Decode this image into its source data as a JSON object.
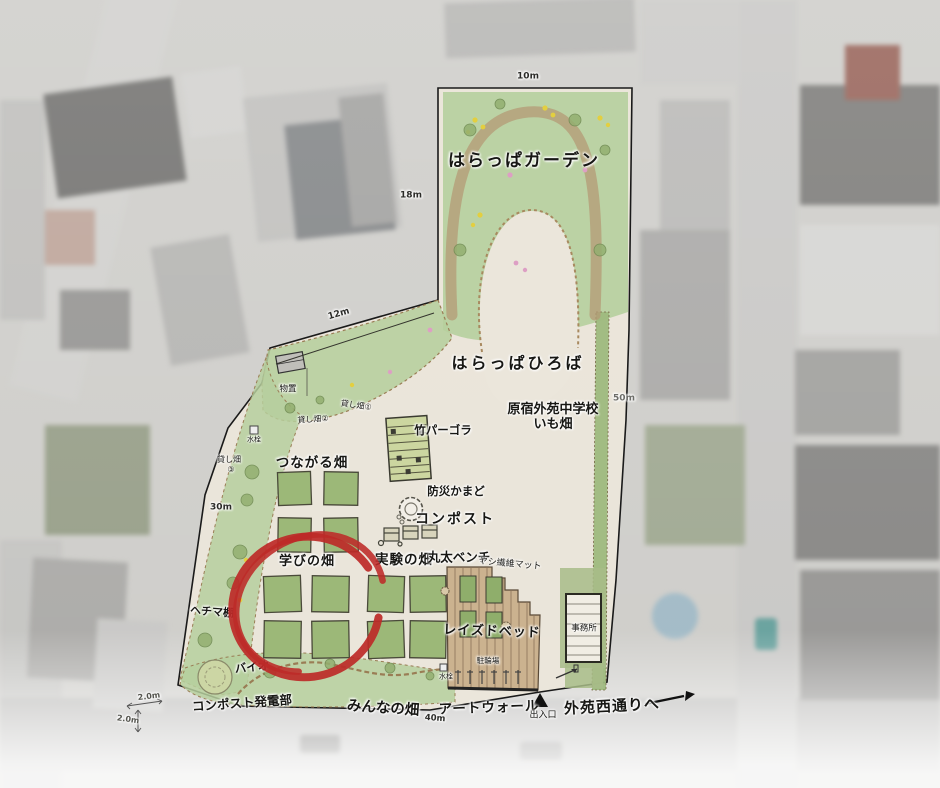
{
  "labels": {
    "harappa_garden": "はらっぱガーデン",
    "harappa_hiroba": "はらっぱひろば",
    "school_field_line1": "原宿外苑中学校",
    "school_field_line2": "いも畑",
    "bamboo_pergola": "竹パーゴラ",
    "disaster_stove": "防災かまど",
    "compost": "コンポスト",
    "tsunagaru_field": "つながる畑",
    "manabi_field": "学びの畑",
    "jikken_field": "実験の畑",
    "log_bench": "丸太ベンチ",
    "palm_fiber_mat": "ヤシ繊維マット",
    "raised_bed": "レイズドベッド",
    "office": "事務所",
    "bicycle_parking": "駐輪場",
    "water_tap_upper": "水栓",
    "water_tap_lower": "水栓",
    "hechima_trellis": "ヘチマ棚",
    "bio_nest": "バイオ",
    "compost_power": "コンポスト発電部",
    "minna_field": "みんなの畑",
    "art_wall": "アートウォール",
    "entrance": "出入口",
    "gaien_street": "外苑西通りへ",
    "storage": "物置",
    "rental_field_1": "貸し畑①",
    "rental_field_2": "貸し畑②",
    "rental_field_3_line1": "貸し畑",
    "rental_field_3_line2": "③"
  },
  "dimensions": {
    "north": "10m",
    "west_upper": "18m",
    "northwest": "12m",
    "west_lower": "30m",
    "east": "50m",
    "south": "40m",
    "southwest_h": "2.0m",
    "southwest_v": "2.0m"
  },
  "annotation": {
    "type": "hand-drawn-red-circle",
    "highlights": "学びの畑",
    "color": "#bd2a28"
  },
  "colors": {
    "site_ground": "#ebe6db",
    "grass_green": "#b6cf9d",
    "bed_green": "#9cb878",
    "path_brown": "#b49a76",
    "raised_bed_tan": "#cbb28f",
    "outline": "#1a1a1a"
  }
}
